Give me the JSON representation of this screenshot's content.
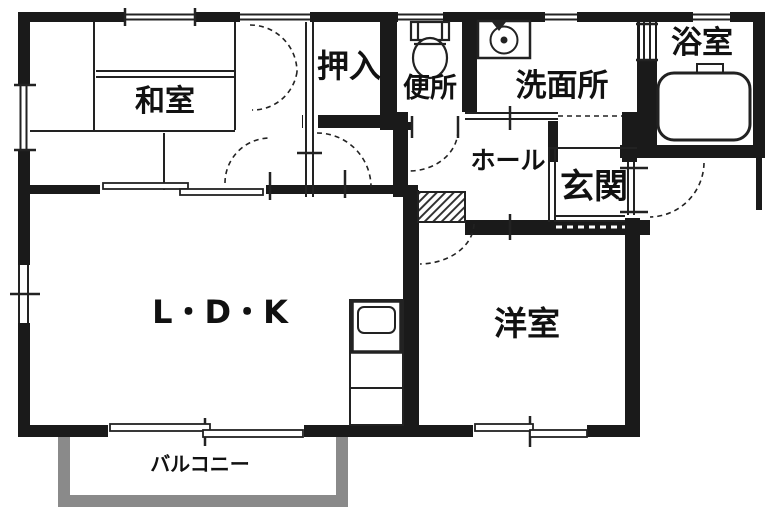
{
  "plan": {
    "title": "apartment-floor-plan",
    "rooms": {
      "washitsu": {
        "label": "和室"
      },
      "oshiire": {
        "label": "押入"
      },
      "benjo": {
        "label": "便所"
      },
      "senmenjo": {
        "label": "洗面所"
      },
      "yokushitsu": {
        "label": "浴室"
      },
      "hall": {
        "label": "ホール"
      },
      "genkan": {
        "label": "玄関"
      },
      "ldk": {
        "label": "L・D・K"
      },
      "yoshitsu": {
        "label": "洋室"
      },
      "balcony": {
        "label": "バルコニー"
      }
    },
    "fixtures": {
      "toilet": "toilet",
      "washing_machine": "washing-machine",
      "bathtub": "bathtub",
      "kitchen_sink": "kitchen-sink-counter"
    },
    "colors": {
      "wall": "#1a1a1a",
      "line": "#222222",
      "balcony": "#8a8a8a",
      "background": "#ffffff"
    }
  }
}
